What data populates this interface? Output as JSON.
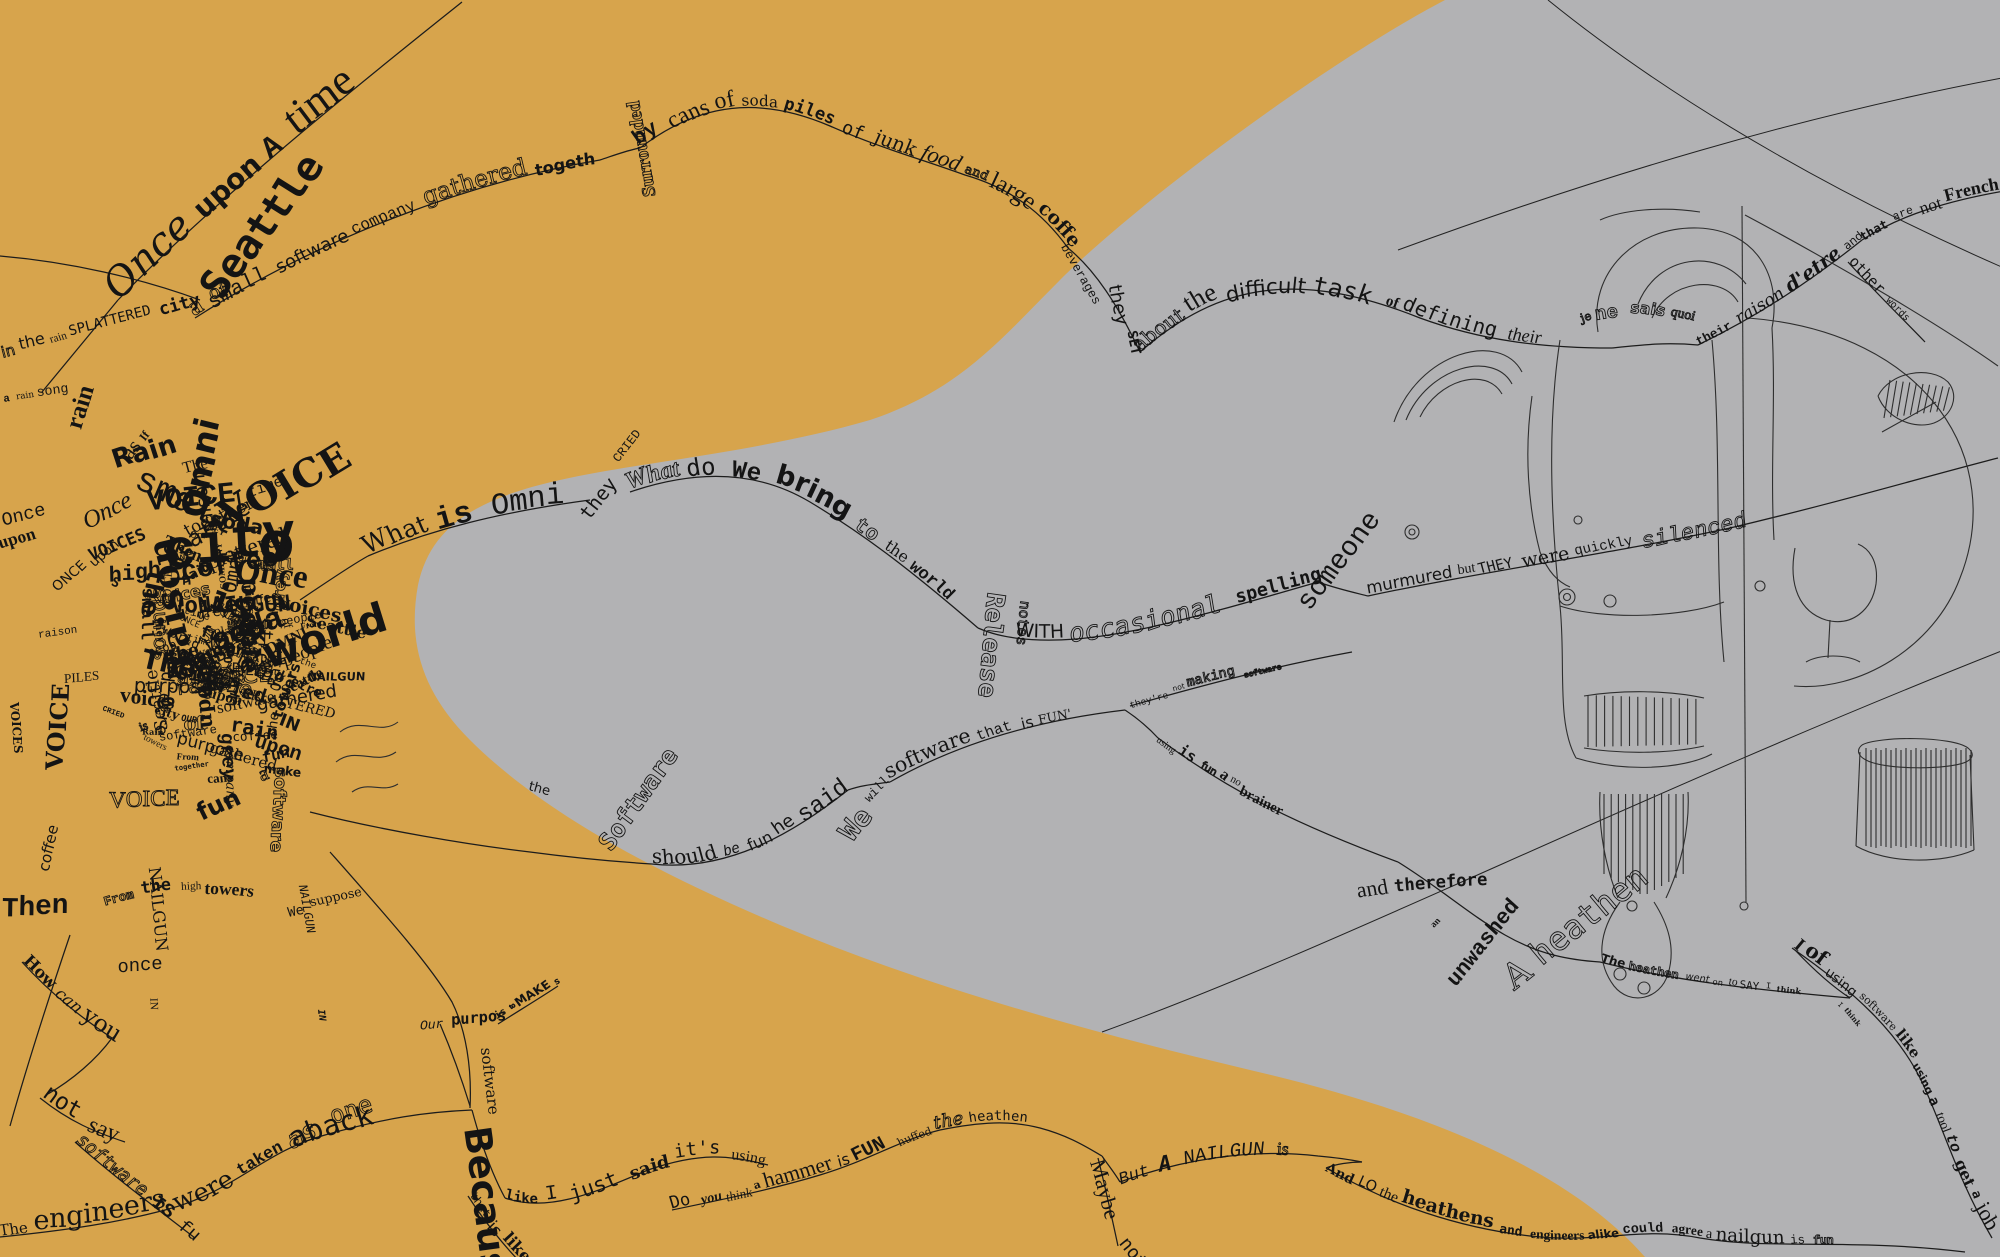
{
  "artwork": {
    "colors": {
      "background_left": "#D7A44C",
      "background_right": "#B2B2B4",
      "ink": "#141414"
    },
    "phrases": {
      "once_upon": {
        "text": "Once upon a time"
      },
      "company": {
        "text": "a small software company gathered together"
      },
      "cans": {
        "text": "by cans of soda piles of junk food and large coffee"
      },
      "about": {
        "text": "about the difficult task of defining their"
      },
      "jenesais": {
        "text": "je ne sais quoi"
      },
      "raison": {
        "text": "their raison d'etre and"
      },
      "notfrench": {
        "text": "that are not French"
      },
      "otherwords": {
        "text": "other words"
      },
      "raincity": {
        "text": "in the rain splattered city of"
      },
      "what_is": {
        "text": "What is Omni"
      },
      "what_do": {
        "text": "What do We bring to the world"
      },
      "with_occ": {
        "text": "With occasional spelling errors"
      },
      "murmured": {
        "text": "murmured but they were quickly silenced"
      },
      "should_fun": {
        "text": "should be fun he said"
      },
      "software_fun": {
        "text": "software that is fun'"
      },
      "notmaking": {
        "text": "they're not making software"
      },
      "using_fun": {
        "text": "using is fun a no brainer"
      },
      "therefore": {
        "text": "and therefore"
      },
      "wenton": {
        "text": "The heathen went on to say I think"
      },
      "tool": {
        "text": "I of using software like using a tool to get a job done"
      },
      "engineers": {
        "text": "The engineers were taken aback"
      },
      "like_said": {
        "text": "like I just said it's using a tool"
      },
      "doyou": {
        "text": "Do you think a hammer is fun huffed the heathen"
      },
      "butnail": {
        "text": "But a NAILGUN is"
      },
      "andlo": {
        "text": "And lo the heathens and engineers alike could agree a nailgun is fun"
      },
      "nail_like": {
        "text": "that is like a nailgun"
      },
      "howcan": {
        "text": "How can you"
      },
      "notsay": {
        "text": "not say"
      },
      "sw_is_fun": {
        "text": "software is fun"
      },
      "towers": {
        "text": "From the high towers"
      },
      "purpose": {
        "text": "Our purpose"
      },
      "make_sw": {
        "text": "is to make software"
      }
    },
    "rotated_words": [
      {
        "text": "Surrounded",
        "x": 655,
        "y": 196,
        "r": -100,
        "s": 21,
        "style": "bold"
      },
      {
        "text": "beverages",
        "x": 1060,
        "y": 247,
        "r": 60,
        "s": 15,
        "style": "normal"
      },
      {
        "text": "they",
        "x": 1112,
        "y": 285,
        "r": 78,
        "s": 14,
        "style": "normal"
      },
      {
        "text": "set",
        "x": 1126,
        "y": 332,
        "r": 80,
        "s": 14,
        "style": "normal"
      },
      {
        "text": "Seattle",
        "x": 222,
        "y": 302,
        "r": -52,
        "s": 26,
        "style": "bold"
      },
      {
        "text": "rain",
        "x": 80,
        "y": 430,
        "r": -72,
        "s": 30,
        "style": "bold"
      },
      {
        "text": "a rain song",
        "x": 4,
        "y": 404,
        "r": -8,
        "s": 12,
        "style": "normal"
      },
      {
        "text": "as If",
        "x": 128,
        "y": 458,
        "r": -52,
        "s": 14,
        "style": "normal"
      },
      {
        "text": "The",
        "x": 184,
        "y": 473,
        "r": -12,
        "s": 15,
        "style": "normal"
      },
      {
        "text": "they",
        "x": 590,
        "y": 522,
        "r": -52,
        "s": 13,
        "style": "normal"
      },
      {
        "text": "cried",
        "x": 620,
        "y": 464,
        "r": -52,
        "s": 15,
        "style": "normal"
      },
      {
        "text": "Release",
        "x": 992,
        "y": 592,
        "r": 95,
        "s": 16,
        "style": "outline"
      },
      {
        "text": "notes",
        "x": 1018,
        "y": 600,
        "r": 95,
        "s": 12,
        "style": "outline"
      },
      {
        "text": "someone",
        "x": 1310,
        "y": 612,
        "r": -52,
        "s": 21,
        "style": "normal"
      },
      {
        "text": "the",
        "x": 528,
        "y": 790,
        "r": 15,
        "s": 12,
        "style": "normal"
      },
      {
        "text": "Software",
        "x": 610,
        "y": 852,
        "r": -55,
        "s": 26,
        "style": "bold"
      },
      {
        "text": "We",
        "x": 850,
        "y": 840,
        "r": -48,
        "s": 18,
        "style": "outline"
      },
      {
        "text": "will",
        "x": 868,
        "y": 802,
        "r": -48,
        "s": 13,
        "style": "normal"
      },
      {
        "text": "an",
        "x": 1436,
        "y": 930,
        "r": -45,
        "s": 12,
        "style": "normal"
      },
      {
        "text": "unwashed",
        "x": 1456,
        "y": 988,
        "r": -52,
        "s": 15,
        "style": "normal"
      },
      {
        "text": "A heathen",
        "x": 1512,
        "y": 988,
        "r": -38,
        "s": 23,
        "style": "outline"
      },
      {
        "text": "I think",
        "x": 1836,
        "y": 1006,
        "r": 50,
        "s": 9,
        "style": "normal"
      },
      {
        "text": "Because",
        "x": 466,
        "y": 1128,
        "r": 83,
        "s": 28,
        "style": "bold"
      },
      {
        "text": "software",
        "x": 480,
        "y": 1048,
        "r": 83,
        "s": 11,
        "style": "normal"
      },
      {
        "text": "Maybe",
        "x": 1090,
        "y": 1162,
        "r": 75,
        "s": 16,
        "style": "normal"
      },
      {
        "text": "not",
        "x": 1120,
        "y": 1242,
        "r": 52,
        "s": 13,
        "style": "normal"
      },
      {
        "text": "as",
        "x": 292,
        "y": 1150,
        "r": -28,
        "s": 22,
        "style": "outline"
      },
      {
        "text": "one",
        "x": 332,
        "y": 1122,
        "r": -18,
        "s": 26,
        "style": "outline"
      },
      {
        "text": "NAILGUN",
        "x": 146,
        "y": 868,
        "r": 85,
        "s": 15,
        "style": "normal"
      },
      {
        "text": "IN",
        "x": 150,
        "y": 998,
        "r": 85,
        "s": 13,
        "style": "normal"
      },
      {
        "text": "NAILGUN",
        "x": 298,
        "y": 886,
        "r": 80,
        "s": 13,
        "style": "normal"
      },
      {
        "text": "IN",
        "x": 316,
        "y": 1010,
        "r": 80,
        "s": 11,
        "style": "normal"
      },
      {
        "text": "coffee",
        "x": 46,
        "y": 872,
        "r": -78,
        "s": 15,
        "style": "normal"
      },
      {
        "text": "We suppose",
        "x": 288,
        "y": 914,
        "r": -12,
        "s": 11,
        "style": "normal"
      },
      {
        "text": "once",
        "x": 118,
        "y": 976,
        "r": -5,
        "s": 15,
        "style": "normal"
      },
      {
        "text": "Then",
        "x": 2,
        "y": 920,
        "r": -4,
        "s": 34,
        "style": "bold"
      },
      {
        "text": "Once",
        "x": 2,
        "y": 522,
        "r": -15,
        "s": 18,
        "style": "normal"
      },
      {
        "text": "upon",
        "x": 0,
        "y": 548,
        "r": -15,
        "s": 13,
        "style": "normal"
      },
      {
        "text": "raison",
        "x": 38,
        "y": 634,
        "r": -8,
        "s": 13,
        "style": "normal"
      },
      {
        "text": "piles",
        "x": 64,
        "y": 682,
        "r": -6,
        "s": 12,
        "style": "normal"
      },
      {
        "text": "VOICES",
        "x": 10,
        "y": 702,
        "r": 85,
        "s": 13,
        "style": "normal"
      },
      {
        "text": "VOICE",
        "x": 60,
        "y": 770,
        "r": -85,
        "s": 17,
        "style": "normal"
      }
    ],
    "cluster": {
      "anchors": [
        {
          "text": "VOICE",
          "x": 148,
          "y": 508,
          "r": -6,
          "s": 30,
          "style": "bold"
        },
        {
          "text": "Rain",
          "x": 116,
          "y": 472,
          "r": -14,
          "s": 24,
          "style": "bold"
        },
        {
          "text": "VOICES",
          "x": 92,
          "y": 562,
          "r": -22,
          "s": 20,
          "style": "normal"
        },
        {
          "text": "Once",
          "x": 86,
          "y": 528,
          "r": -28,
          "s": 18,
          "style": "normal"
        },
        {
          "text": "O",
          "x": 258,
          "y": 562,
          "r": 0,
          "s": 34,
          "style": "bold"
        },
        {
          "text": "Omni",
          "x": 236,
          "y": 594,
          "r": -80,
          "s": 20,
          "style": "normal"
        },
        {
          "text": "Seattle",
          "x": 168,
          "y": 562,
          "r": -32,
          "s": 18,
          "style": "normal"
        },
        {
          "text": "grey",
          "x": 198,
          "y": 622,
          "r": -10,
          "s": 16,
          "style": "normal"
        },
        {
          "text": "S",
          "x": 252,
          "y": 642,
          "r": -55,
          "s": 38,
          "style": "bold"
        },
        {
          "text": "people",
          "x": 150,
          "y": 658,
          "r": -18,
          "s": 15,
          "style": "normal"
        },
        {
          "text": "voices",
          "x": 120,
          "y": 700,
          "r": 8,
          "s": 14,
          "style": "normal"
        },
        {
          "text": "Our",
          "x": 210,
          "y": 700,
          "r": -75,
          "s": 16,
          "style": "normal"
        },
        {
          "text": "rain",
          "x": 230,
          "y": 730,
          "r": 12,
          "s": 18,
          "style": "bold"
        },
        {
          "text": "software",
          "x": 160,
          "y": 745,
          "r": -8,
          "s": 13,
          "style": "normal"
        },
        {
          "text": "Once upon",
          "x": 60,
          "y": 595,
          "r": -40,
          "s": 14,
          "style": "normal"
        },
        {
          "text": "time",
          "x": 250,
          "y": 500,
          "r": -20,
          "s": 16,
          "style": "normal"
        },
        {
          "text": "of",
          "x": 280,
          "y": 620,
          "r": 70,
          "s": 14,
          "style": "normal"
        },
        {
          "text": "high",
          "x": 260,
          "y": 680,
          "r": -60,
          "s": 15,
          "style": "normal"
        },
        {
          "text": "the",
          "x": 300,
          "y": 660,
          "r": 20,
          "s": 13,
          "style": "normal"
        },
        {
          "text": "towers",
          "x": 285,
          "y": 720,
          "r": -70,
          "s": 14,
          "style": "normal"
        }
      ],
      "words": [
        "the",
        "rain",
        "Voice",
        "of",
        "a",
        "software",
        "Seattle",
        "Once",
        "upon",
        "time",
        "company",
        "small",
        "gathered",
        "together",
        "people",
        "grey",
        "city",
        "splattered",
        "raison",
        "d'etre",
        "piles",
        "soda",
        "cans",
        "coffee",
        "VOICE",
        "is",
        "fun",
        "we",
        "What",
        "Omni",
        "world",
        "bring",
        "purpose",
        "make",
        "Our",
        "said",
        "cried",
        "they",
        "high",
        "towers",
        "From",
        "NAILGUN",
        "IN",
        "voices",
        "Rain",
        "O",
        "S",
        "once",
        "Then",
        "sounds"
      ]
    }
  }
}
